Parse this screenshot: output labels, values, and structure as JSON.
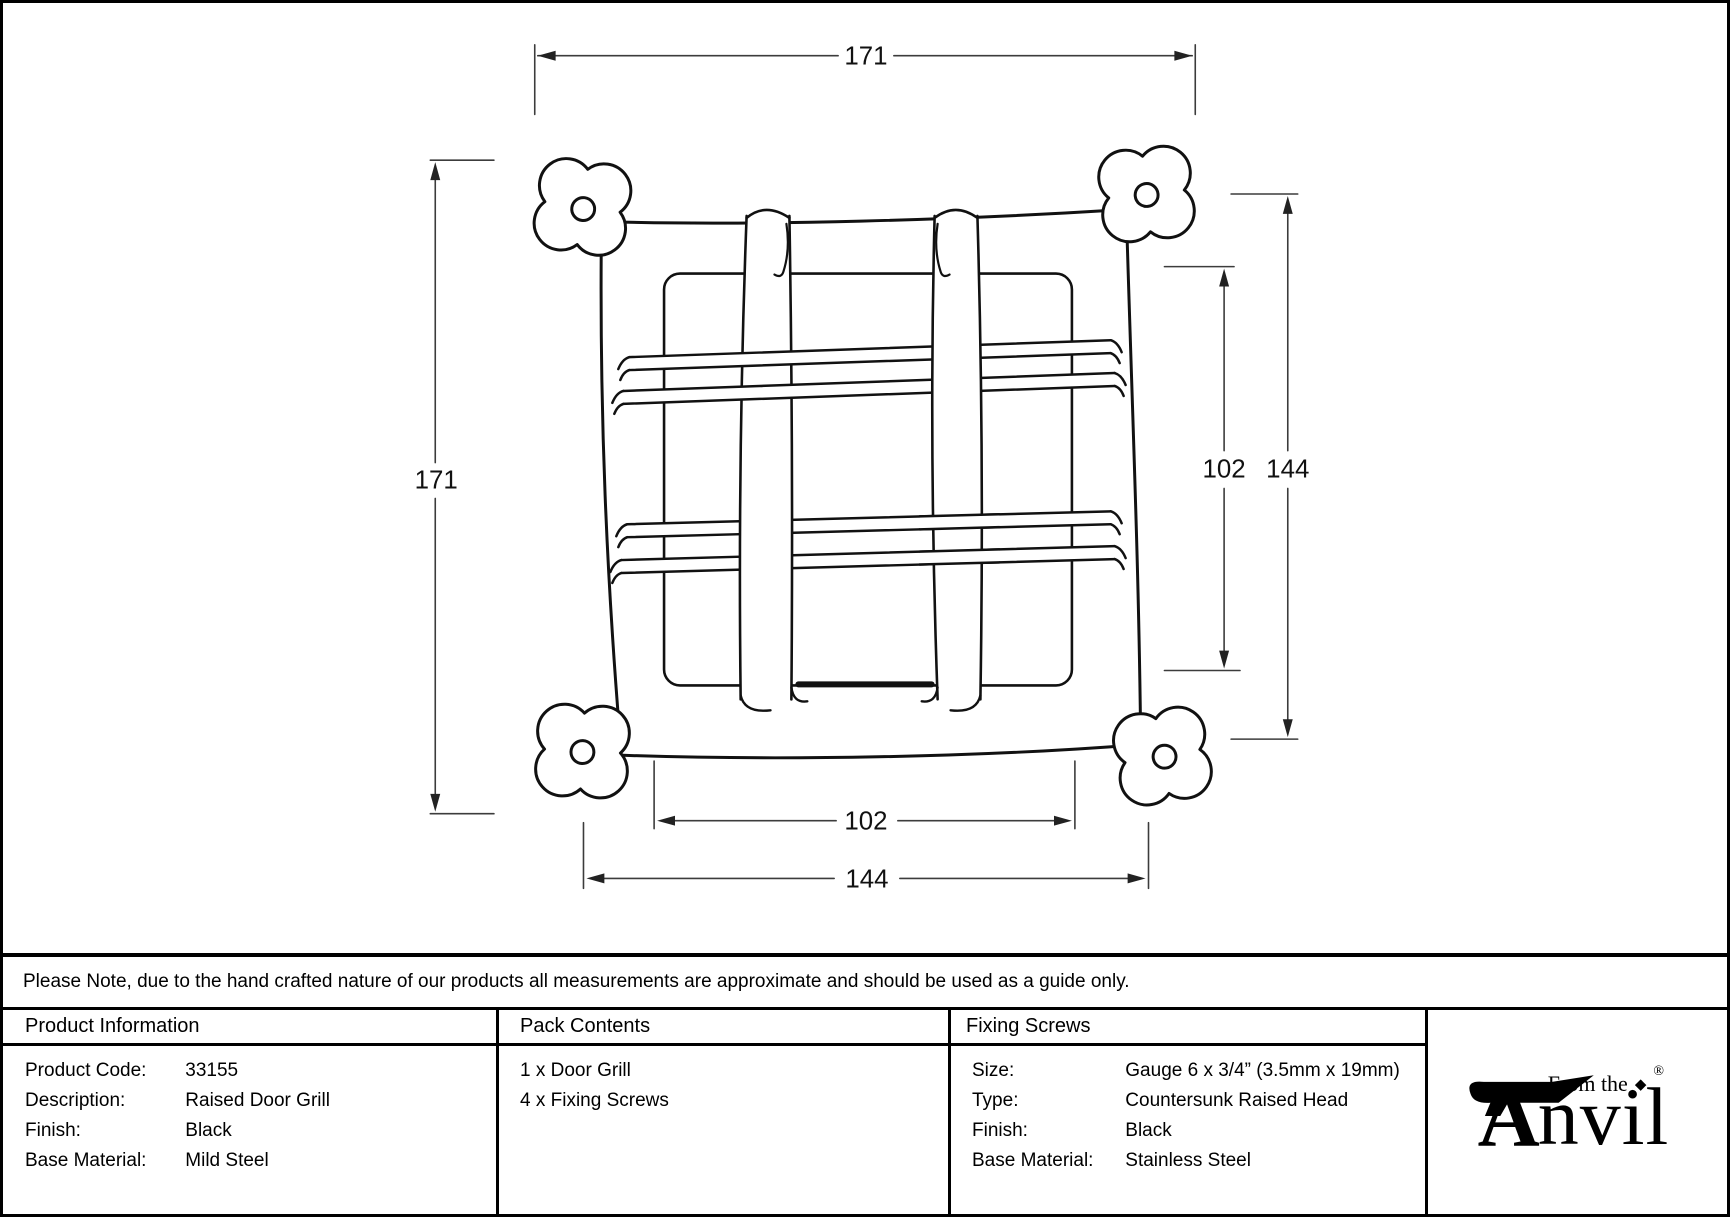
{
  "note": "Please Note, due to the hand crafted nature of our products all measurements are approximate and should be used as a guide only.",
  "drawing": {
    "dim_overall_width": "171",
    "dim_overall_height": "171",
    "dim_inner_height": "102",
    "dim_plate_height": "144",
    "dim_inner_width": "102",
    "dim_plate_width": "144"
  },
  "table": {
    "product_information": {
      "title": "Product Information",
      "rows": [
        {
          "label": "Product Code:",
          "value": "33155"
        },
        {
          "label": "Description:",
          "value": "Raised Door Grill"
        },
        {
          "label": "Finish:",
          "value": "Black"
        },
        {
          "label": "Base Material:",
          "value": "Mild Steel"
        }
      ]
    },
    "pack_contents": {
      "title": "Pack Contents",
      "items": [
        "1 x Door Grill",
        "4 x Fixing Screws"
      ]
    },
    "fixing_screws": {
      "title": "Fixing Screws",
      "rows": [
        {
          "label": "Size:",
          "value": "Gauge 6 x 3/4” (3.5mm x 19mm)"
        },
        {
          "label": "Type:",
          "value": "Countersunk Raised Head"
        },
        {
          "label": "Finish:",
          "value": "Black"
        },
        {
          "label": "Base Material:",
          "value": "Stainless Steel"
        }
      ]
    }
  },
  "logo": {
    "from_the": "From the",
    "diamond": "◆",
    "initial": "A",
    "rest": "nvil",
    "registered": "®"
  },
  "colors": {
    "line": "#111111",
    "dim_line": "#3c3c3c"
  }
}
